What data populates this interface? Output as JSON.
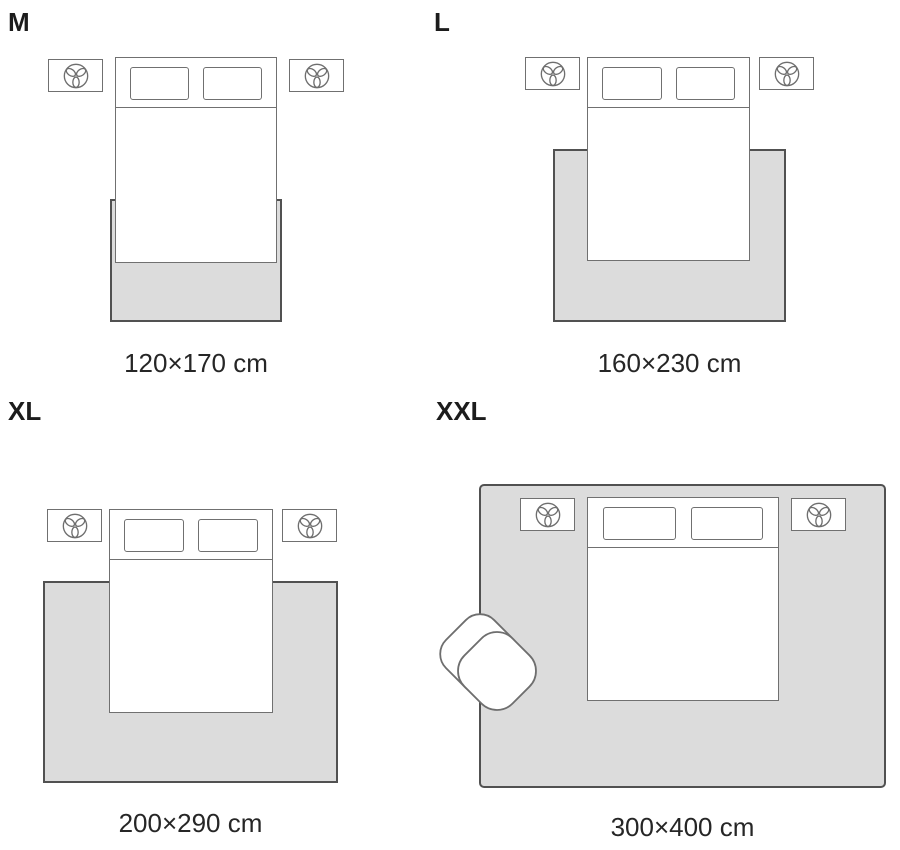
{
  "title": "Rug size guide with bedroom layout diagrams",
  "sizes": [
    {
      "id": "m",
      "label": "M",
      "dimensions": "120×170 cm"
    },
    {
      "id": "l",
      "label": "L",
      "dimensions": "160×230 cm"
    },
    {
      "id": "xl",
      "label": "XL",
      "dimensions": "200×290 cm"
    },
    {
      "id": "xxl",
      "label": "XXL",
      "dimensions": "300×400 cm"
    }
  ],
  "icons": {
    "nightstand_icon": "plant-icon",
    "extra_furniture_xxl": "armchair"
  },
  "colors": {
    "background": "#ffffff",
    "rug_fill": "#dcdcdc",
    "rug_border": "#515151",
    "furniture_line": "#707070",
    "text": "#1c1c1c"
  }
}
